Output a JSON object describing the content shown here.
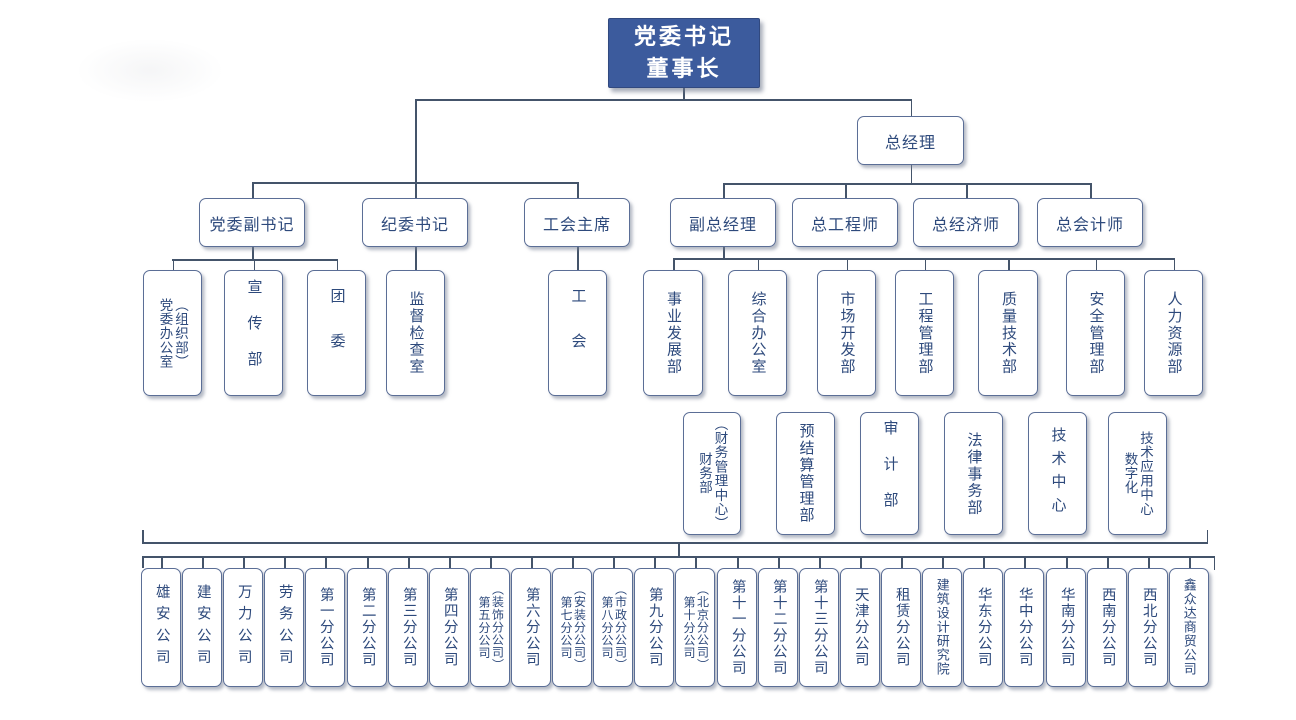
{
  "chart": {
    "root_label": "党委书记\n董事长",
    "general_manager": "总经理",
    "level2_left": [
      "党委副书记",
      "纪委书记",
      "工会主席"
    ],
    "level2_right": [
      "副总经理",
      "总工程师",
      "总经济师",
      "总会计师"
    ],
    "party_departments": [
      "党委办公室\n（组织部）",
      "宣传部",
      "团委",
      "监督检查室"
    ],
    "union_department": "工会",
    "departments_row1": [
      "事业发展部",
      "综合办公室",
      "市场开发部",
      "工程管理部",
      "质量技术部",
      "安全管理部",
      "人力资源部"
    ],
    "departments_row2": [
      "财务部\n（财务管理中心）",
      "预结算管理部",
      "审计部",
      "法律事务部",
      "技术中心",
      "数字化\n技术应用中心"
    ],
    "companies": [
      "雄安公司",
      "建安公司",
      "万力公司",
      "劳务公司",
      "第一分公司",
      "第二分公司",
      "第三分公司",
      "第四分公司",
      "第五分公司\n（装饰分公司）",
      "第六分公司",
      "第七分公司\n（安装分公司）",
      "第八分公司\n（市政分公司）",
      "第九分公司",
      "第十分公司\n（北京分公司）",
      "第十一分公司",
      "第十二分公司",
      "第十三分公司",
      "天津分公司",
      "租赁分公司",
      "建筑设计研究院",
      "华东分公司",
      "华中分公司",
      "华南分公司",
      "西南分公司",
      "西北分公司",
      "鑫众达商贸公司"
    ]
  },
  "colors": {
    "root_fill": "#3c5b9d",
    "box_border": "#5b6e96",
    "text": "#2e4a7c",
    "line": "#44546a"
  }
}
